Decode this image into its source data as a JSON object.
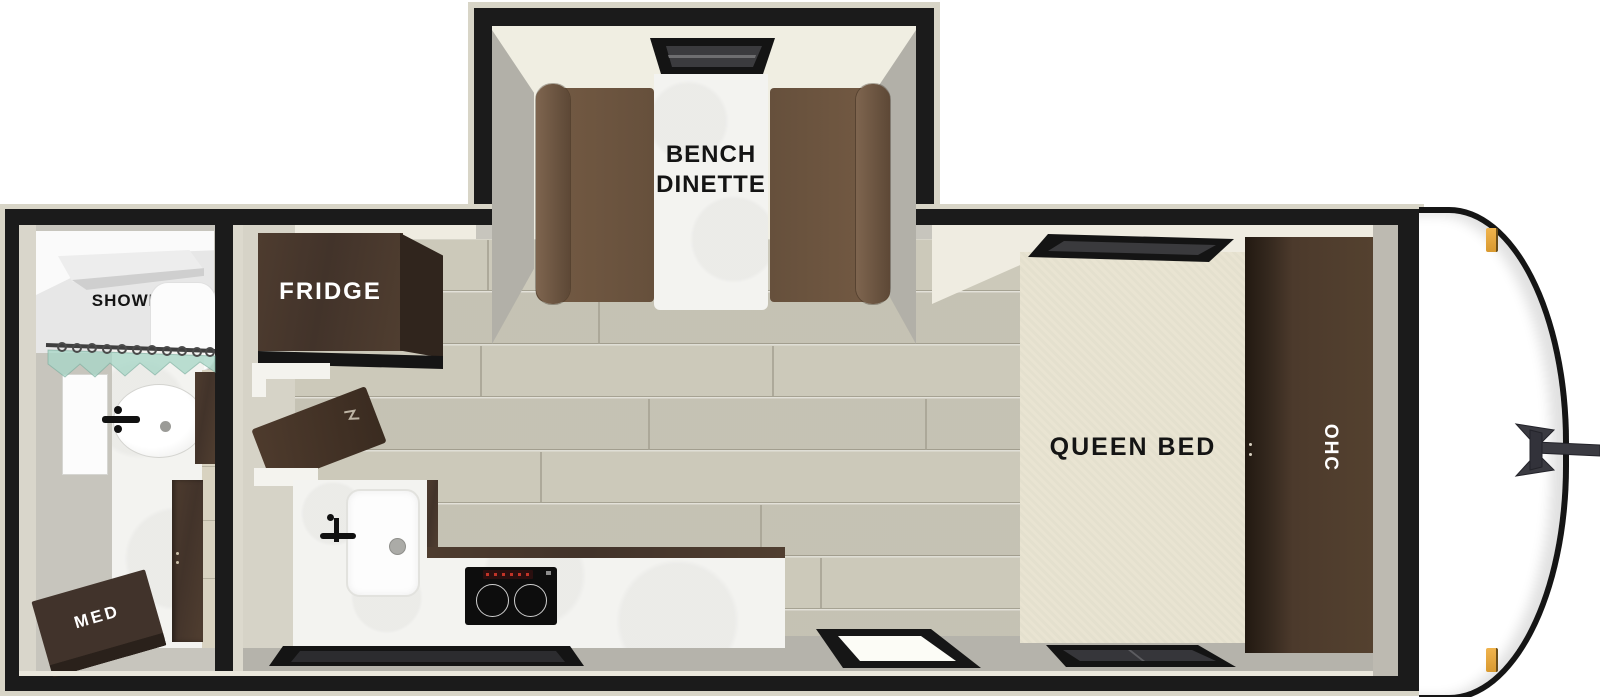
{
  "labels": {
    "shower": "SHOWER",
    "med": "MED",
    "fridge": "FRIDGE",
    "dinette_line1": "BENCH",
    "dinette_line2": "DINETTE",
    "queen_bed": "QUEEN BED",
    "overhead_cabinet": "OHC"
  },
  "colors": {
    "wall_black": "#1b1b1b",
    "wall_trim_cream": "#d8d5c7",
    "interior_cream": "#efece1",
    "floor_plank": "#ccc9ba",
    "floor_gray": "#b5b3ab",
    "cabinet_wood": "#46362b",
    "bench_brown": "#6b5340",
    "bed_cream": "#e9e4d2",
    "counter_white": "#f3f3f0",
    "curtain_teal": "#a8d6c7",
    "marker_amber": "#e3a23c"
  }
}
